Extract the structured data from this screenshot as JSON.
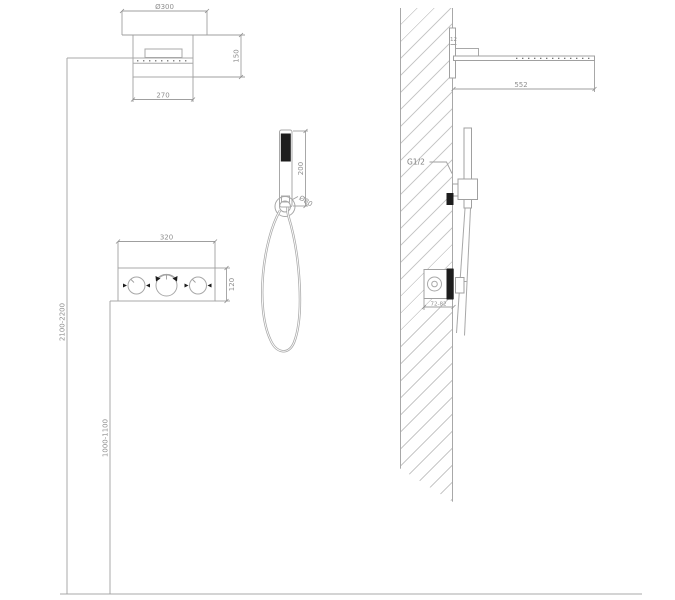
{
  "colors": {
    "line": "#a8a8a8",
    "dark_fill": "#1d1d1d",
    "dimension_text": "#8f8f8f",
    "background": "#ffffff"
  },
  "labels": {
    "head_diameter": "Ø300",
    "head_width": "270",
    "head_height": "150",
    "head_depth": "552",
    "bracket_offset": "12",
    "panel_width": "320",
    "panel_height": "120",
    "handshower_length": "200",
    "holder_diameter": "Ø80",
    "thread_label": "G1/2",
    "valve_recess_depth": "72-82",
    "shower_mount_height": "2100-2200",
    "valve_mount_height": "1000-1100"
  }
}
